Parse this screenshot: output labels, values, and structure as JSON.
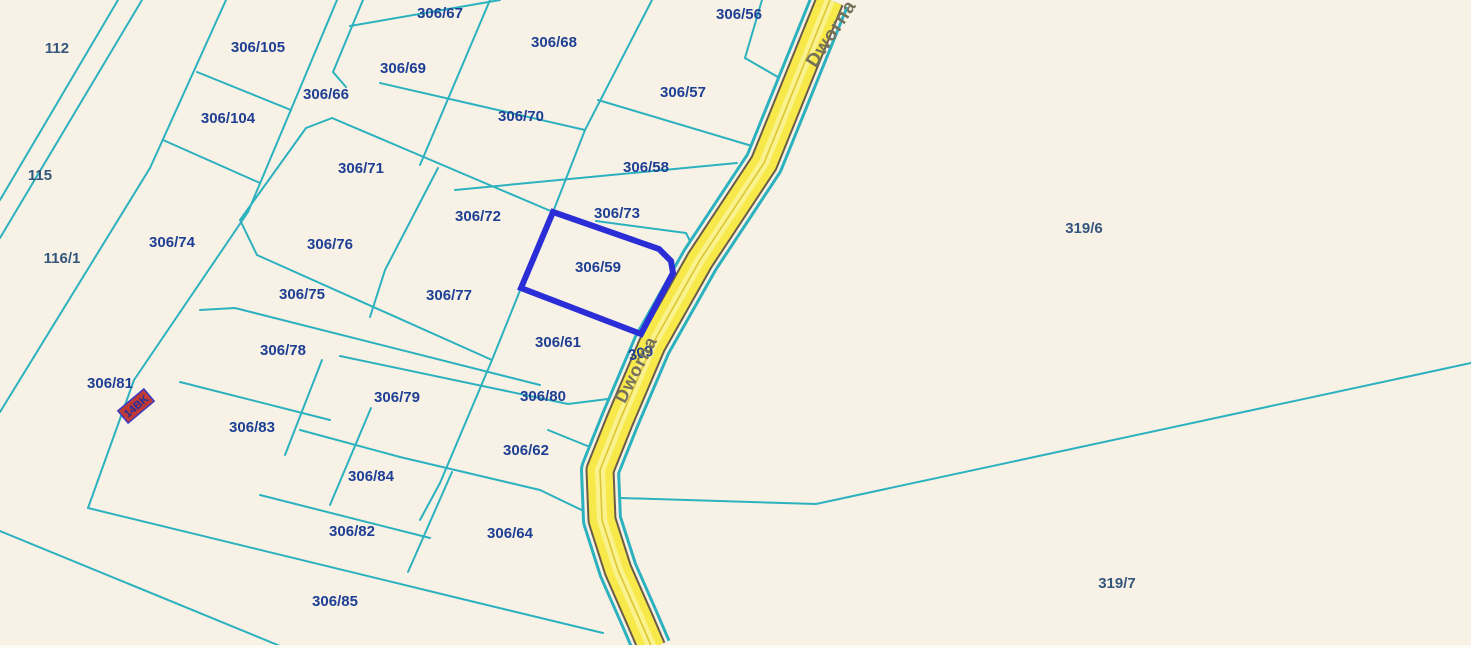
{
  "map": {
    "description": "Cadastral parcel map with highlighted parcel 306/59 on Dworna street",
    "colors": {
      "background": "#f8f2e6",
      "boundary": "#2cb1bf",
      "label_block": "#1e3f94",
      "label_outer": "#35567c",
      "highlight": "#2b2ed6",
      "road_casing_dark": "#6a5c49",
      "road_fill": "#f8e94a",
      "road_stripe": "#faf28d",
      "road_thin_line": "#ddc635",
      "road_gap": "#f8f2e6",
      "road_text": "#75705a",
      "building_fill": "#c03a35",
      "building_stroke": "#3b3bc4",
      "building_text": "#1e2f9e",
      "bottom_strip": "#fbfaf3"
    },
    "canvas": {
      "width": 1471,
      "height": 648
    },
    "road": {
      "name": "Dworna",
      "centerline": [
        [
          830,
          0
        ],
        [
          764,
          163
        ],
        [
          700,
          260
        ],
        [
          652,
          345
        ],
        [
          620,
          420
        ],
        [
          600,
          470
        ],
        [
          602,
          520
        ],
        [
          618,
          570
        ],
        [
          640,
          620
        ],
        [
          652,
          648
        ]
      ],
      "widths": {
        "outer_cyan": 40,
        "gap": 34,
        "casing": 29,
        "fill": 25,
        "stripe": 10,
        "thin": 1.6
      },
      "name_labels": [
        {
          "text": "Dworna",
          "x": 832,
          "y": 34,
          "rotation": -57,
          "size": 19
        },
        {
          "text": "Dworna",
          "x": 637,
          "y": 370,
          "rotation": -63,
          "size": 18
        }
      ]
    },
    "boundary_segments": [
      {
        "pts": [
          [
            118,
            0
          ],
          [
            0,
            200
          ]
        ]
      },
      {
        "pts": [
          [
            142,
            0
          ],
          [
            0,
            238
          ]
        ]
      },
      {
        "pts": [
          [
            226,
            0
          ],
          [
            150,
            168
          ],
          [
            0,
            412
          ]
        ]
      },
      {
        "pts": [
          [
            0,
            531
          ],
          [
            285,
            648
          ]
        ]
      },
      {
        "pts": [
          [
            197,
            72
          ],
          [
            291,
            110
          ]
        ]
      },
      {
        "pts": [
          [
            163,
            140
          ],
          [
            260,
            183
          ]
        ]
      },
      {
        "pts": [
          [
            337,
            0
          ],
          [
            248,
            212
          ],
          [
            134,
            380
          ],
          [
            88,
            508
          ]
        ]
      },
      {
        "pts": [
          [
            363,
            0
          ],
          [
            333,
            72
          ],
          [
            346,
            87
          ]
        ]
      },
      {
        "pts": [
          [
            350,
            26
          ],
          [
            500,
            0
          ]
        ]
      },
      {
        "pts": [
          [
            490,
            0
          ],
          [
            420,
            165
          ]
        ]
      },
      {
        "pts": [
          [
            652,
            0
          ],
          [
            585,
            130
          ]
        ]
      },
      {
        "pts": [
          [
            585,
            130
          ],
          [
            553,
            212
          ],
          [
            521,
            288
          ],
          [
            492,
            360
          ],
          [
            440,
            483
          ],
          [
            420,
            520
          ]
        ]
      },
      {
        "pts": [
          [
            762,
            0
          ],
          [
            745,
            58
          ],
          [
            783,
            80
          ]
        ]
      },
      {
        "pts": [
          [
            332,
            118
          ],
          [
            306,
            128
          ],
          [
            240,
            220
          ],
          [
            257,
            255
          ]
        ]
      },
      {
        "pts": [
          [
            332,
            118
          ],
          [
            553,
            212
          ]
        ]
      },
      {
        "pts": [
          [
            380,
            83
          ],
          [
            585,
            130
          ]
        ]
      },
      {
        "pts": [
          [
            438,
            168
          ],
          [
            385,
            270
          ],
          [
            370,
            317
          ]
        ]
      },
      {
        "pts": [
          [
            257,
            255
          ],
          [
            492,
            360
          ]
        ]
      },
      {
        "pts": [
          [
            200,
            310
          ],
          [
            235,
            308
          ],
          [
            540,
            385
          ]
        ]
      },
      {
        "pts": [
          [
            455,
            190
          ],
          [
            737,
            163
          ]
        ]
      },
      {
        "pts": [
          [
            596,
            221
          ],
          [
            686,
            233
          ],
          [
            694,
            249
          ]
        ]
      },
      {
        "pts": [
          [
            598,
            100
          ],
          [
            752,
            146
          ],
          [
            760,
            162
          ]
        ]
      },
      {
        "pts": [
          [
            641,
            334
          ],
          [
            655,
            345
          ]
        ]
      },
      {
        "pts": [
          [
            340,
            356
          ],
          [
            568,
            404
          ],
          [
            608,
            399
          ]
        ]
      },
      {
        "pts": [
          [
            548,
            430
          ],
          [
            590,
            447
          ]
        ]
      },
      {
        "pts": [
          [
            300,
            430
          ],
          [
            400,
            457
          ],
          [
            540,
            490
          ],
          [
            592,
            515
          ]
        ]
      },
      {
        "pts": [
          [
            371,
            408
          ],
          [
            330,
            505
          ]
        ]
      },
      {
        "pts": [
          [
            180,
            382
          ],
          [
            330,
            420
          ]
        ]
      },
      {
        "pts": [
          [
            322,
            360
          ],
          [
            285,
            455
          ]
        ]
      },
      {
        "pts": [
          [
            260,
            495
          ],
          [
            430,
            538
          ]
        ]
      },
      {
        "pts": [
          [
            452,
            472
          ],
          [
            408,
            572
          ]
        ]
      },
      {
        "pts": [
          [
            88,
            508
          ],
          [
            458,
            598
          ],
          [
            603,
            633
          ]
        ]
      },
      {
        "pts": [
          [
            621,
            498
          ],
          [
            816,
            504
          ],
          [
            1471,
            363
          ]
        ]
      }
    ],
    "highlighted_parcel": {
      "id": "306/59",
      "polygon": [
        [
          553,
          212
        ],
        [
          659,
          249
        ],
        [
          671,
          261
        ],
        [
          673,
          273
        ],
        [
          641,
          334
        ],
        [
          521,
          288
        ]
      ],
      "stroke_width": 6
    },
    "parcel_labels": [
      {
        "text": "112",
        "x": 57,
        "y": 49,
        "cls": "outer"
      },
      {
        "text": "115",
        "x": 40,
        "y": 176,
        "cls": "outer"
      },
      {
        "text": "116/1",
        "x": 62,
        "y": 259,
        "cls": "outer"
      },
      {
        "text": "306/105",
        "x": 258,
        "y": 48,
        "cls": "block"
      },
      {
        "text": "306/104",
        "x": 228,
        "y": 119,
        "cls": "block"
      },
      {
        "text": "306/74",
        "x": 172,
        "y": 243,
        "cls": "block"
      },
      {
        "text": "306/66",
        "x": 326,
        "y": 95,
        "cls": "block"
      },
      {
        "text": "306/69",
        "x": 403,
        "y": 69,
        "cls": "block"
      },
      {
        "text": "306/67",
        "x": 440,
        "y": 14,
        "cls": "block"
      },
      {
        "text": "306/68",
        "x": 554,
        "y": 43,
        "cls": "block"
      },
      {
        "text": "306/56",
        "x": 739,
        "y": 15,
        "cls": "block"
      },
      {
        "text": "306/57",
        "x": 683,
        "y": 93,
        "cls": "block"
      },
      {
        "text": "306/70",
        "x": 521,
        "y": 117,
        "cls": "block"
      },
      {
        "text": "306/58",
        "x": 646,
        "y": 168,
        "cls": "block"
      },
      {
        "text": "306/71",
        "x": 361,
        "y": 169,
        "cls": "block"
      },
      {
        "text": "306/72",
        "x": 478,
        "y": 217,
        "cls": "block"
      },
      {
        "text": "306/73",
        "x": 617,
        "y": 214,
        "cls": "block"
      },
      {
        "text": "306/76",
        "x": 330,
        "y": 245,
        "cls": "block"
      },
      {
        "text": "306/59",
        "x": 598,
        "y": 268,
        "cls": "block"
      },
      {
        "text": "306/75",
        "x": 302,
        "y": 295,
        "cls": "block"
      },
      {
        "text": "306/77",
        "x": 449,
        "y": 296,
        "cls": "block"
      },
      {
        "text": "306/61",
        "x": 558,
        "y": 343,
        "cls": "block"
      },
      {
        "text": "309",
        "x": 641,
        "y": 354,
        "cls": "block",
        "rotation": -12
      },
      {
        "text": "306/78",
        "x": 283,
        "y": 351,
        "cls": "block"
      },
      {
        "text": "306/81",
        "x": 110,
        "y": 384,
        "cls": "block"
      },
      {
        "text": "306/79",
        "x": 397,
        "y": 398,
        "cls": "block"
      },
      {
        "text": "306/80",
        "x": 543,
        "y": 397,
        "cls": "block"
      },
      {
        "text": "306/83",
        "x": 252,
        "y": 428,
        "cls": "block"
      },
      {
        "text": "306/62",
        "x": 526,
        "y": 451,
        "cls": "block"
      },
      {
        "text": "306/84",
        "x": 371,
        "y": 477,
        "cls": "block"
      },
      {
        "text": "306/82",
        "x": 352,
        "y": 532,
        "cls": "block"
      },
      {
        "text": "306/64",
        "x": 510,
        "y": 534,
        "cls": "block"
      },
      {
        "text": "306/85",
        "x": 335,
        "y": 602,
        "cls": "block"
      },
      {
        "text": "319/6",
        "x": 1084,
        "y": 229,
        "cls": "outer"
      },
      {
        "text": "319/7",
        "x": 1117,
        "y": 584,
        "cls": "outer"
      }
    ],
    "label_font_size": 15,
    "building_marker": {
      "text": "14BK",
      "x": 136,
      "y": 406,
      "rotation": -40,
      "width": 34,
      "height": 16,
      "font_size": 11
    },
    "bottom_strip_height": 3
  }
}
